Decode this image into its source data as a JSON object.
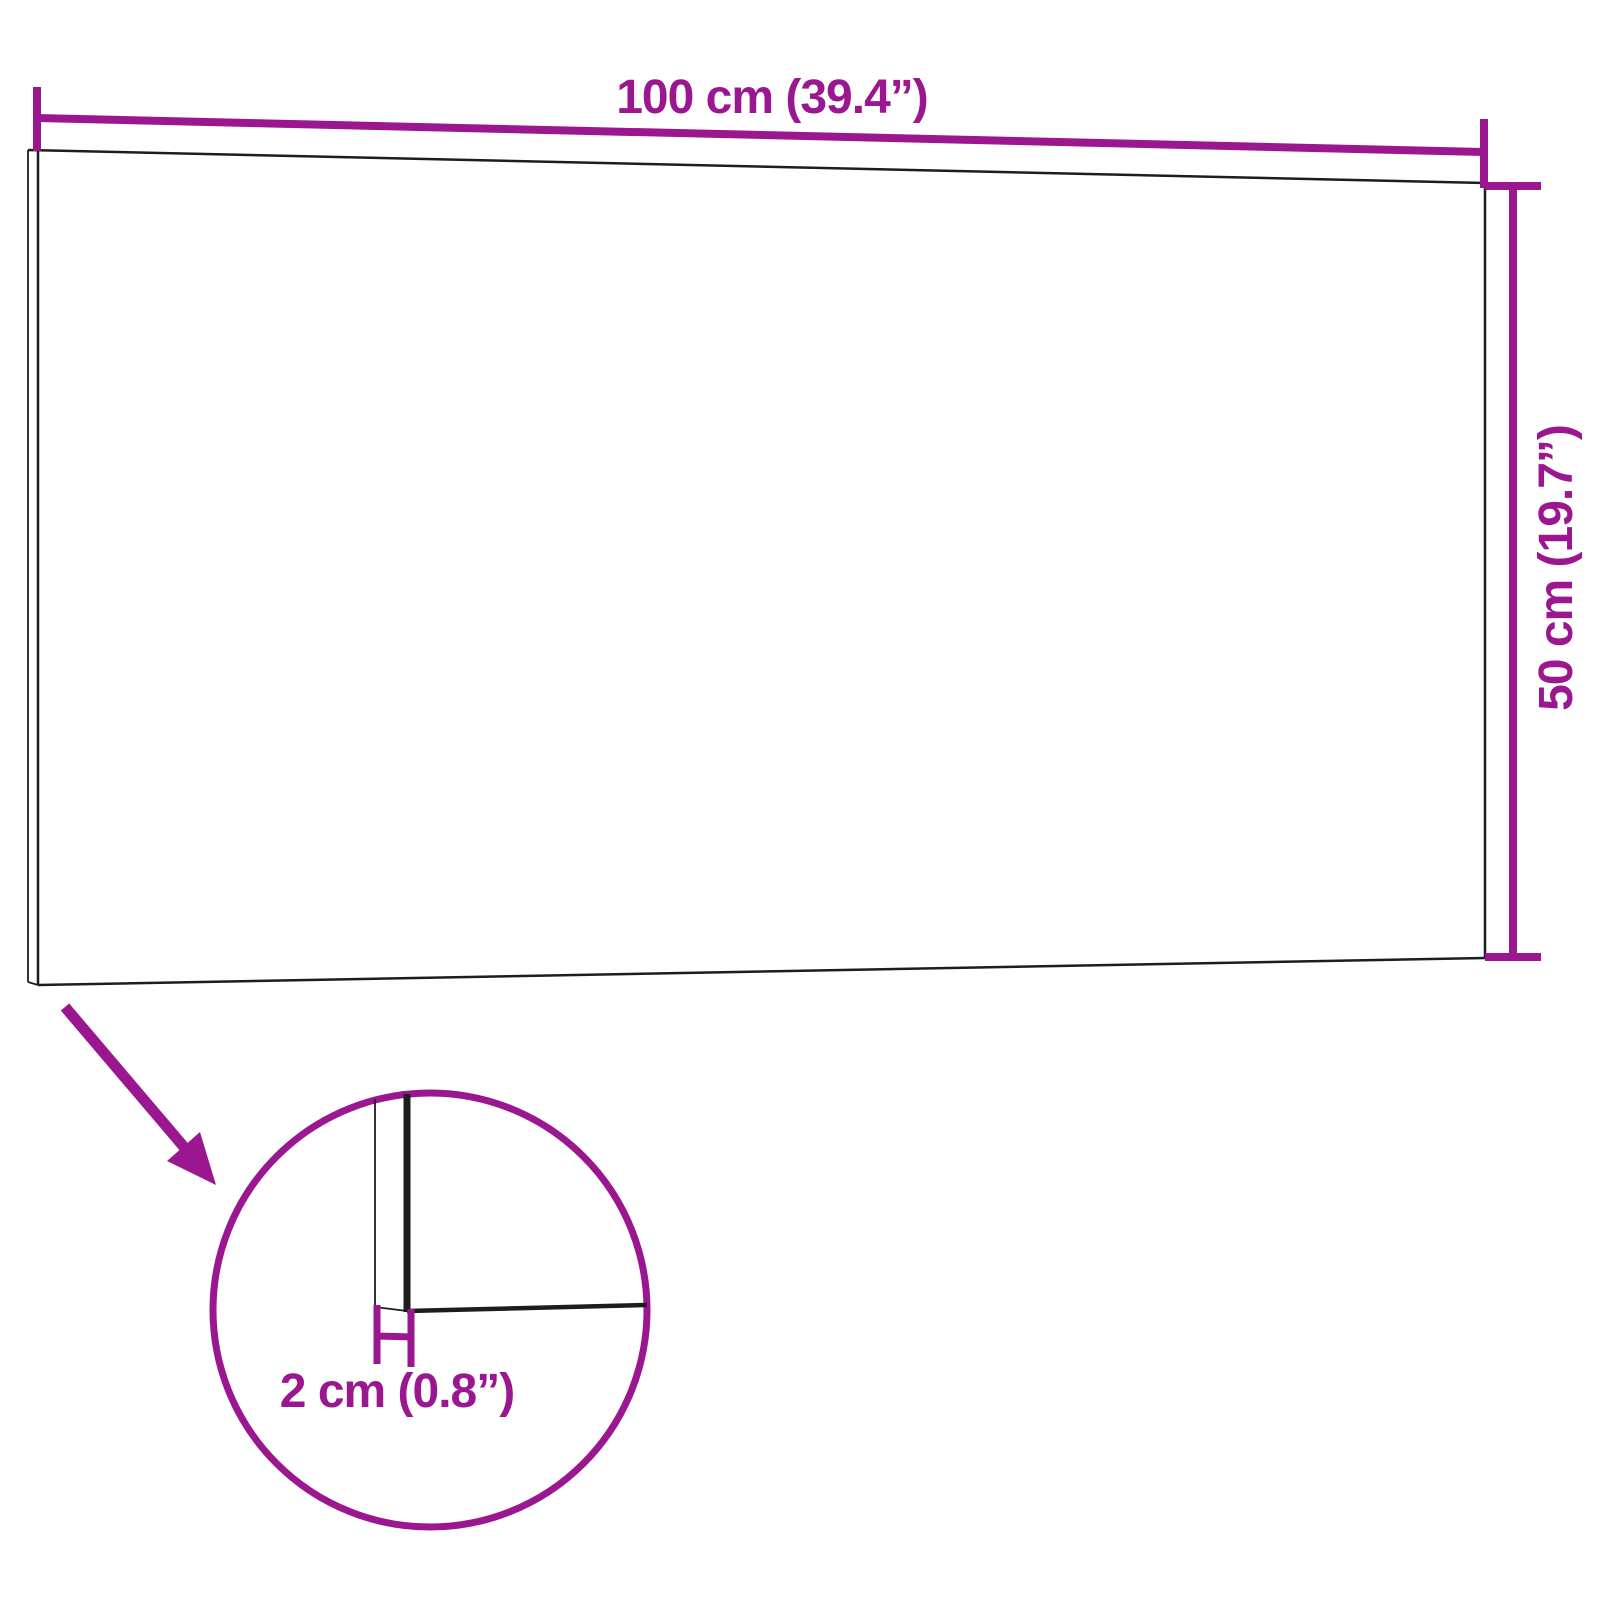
{
  "diagram": {
    "labels": {
      "width": "100 cm (39.4”)",
      "height": "50 cm (19.7”)",
      "thickness": "2 cm (0.8”)"
    },
    "colors": {
      "accent": "#9A1790",
      "line": "#1D1D1D",
      "background": "#FFFFFF"
    }
  }
}
